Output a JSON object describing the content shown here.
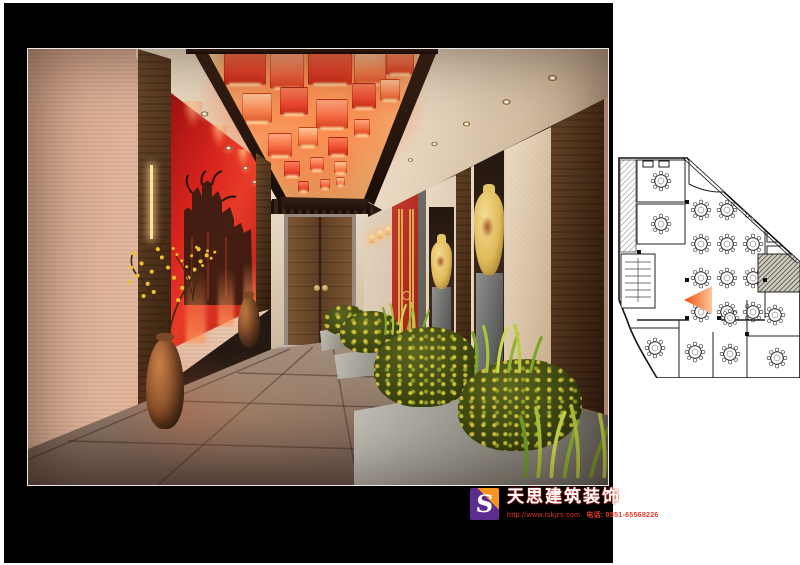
{
  "branding": {
    "logo_letter": "S",
    "company_name": "天思建筑装饰",
    "website": "http://www.tskjzs.com",
    "phone": "电话: 0551-65568226",
    "colors": {
      "logo_purple": "#5c2d91",
      "logo_orange": "#f7941e",
      "company_name_fill": "#ffffff",
      "company_name_outline": "#e0301e",
      "contact_red": "#e8382b"
    }
  },
  "palette": {
    "lantern_orange": "#f4523a",
    "feature_wall_red": "#d8241d",
    "wood_brown": "#5a3d28",
    "wall_cream": "#e7d6c2",
    "left_wall_beige": "#dcae96",
    "floor_gray_brown": "#8a7567",
    "plan_view_marker": "#f05a28",
    "board_background": "#000000",
    "page_background": "#ffffff"
  }
}
